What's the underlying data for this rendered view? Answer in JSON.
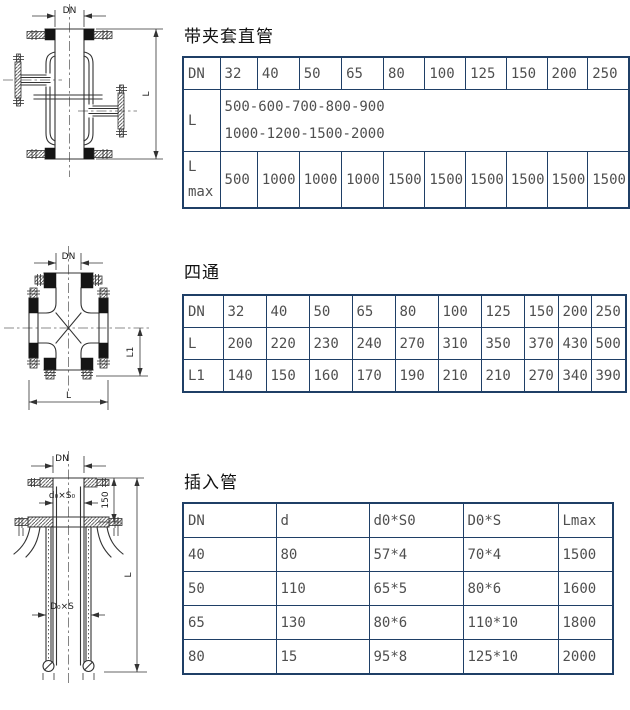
{
  "colors": {
    "table_border": "#1f3f66",
    "table_text": "#4f4f4f",
    "line": "#333333"
  },
  "section1": {
    "title": "带夹套直管",
    "drawing": {
      "dim_dn": "DN",
      "dim_l": "L"
    },
    "table": {
      "row_dn": {
        "label": "DN",
        "values": [
          "32",
          "40",
          "50",
          "65",
          "80",
          "100",
          "125",
          "150",
          "200",
          "250"
        ]
      },
      "row_l": {
        "label": "L",
        "line1": "500-600-700-800-900",
        "line2": "1000-1200-1500-2000"
      },
      "row_lmax": {
        "label_line1": "L",
        "label_line2": "max",
        "values": [
          "500",
          "1000",
          "1000",
          "1000",
          "1500",
          "1500",
          "1500",
          "1500",
          "1500",
          "1500"
        ]
      }
    }
  },
  "section2": {
    "title": "四通",
    "drawing": {
      "dim_dn": "DN",
      "dim_l1": "L1",
      "dim_l": "L"
    },
    "table": {
      "row_dn": {
        "label": "DN",
        "values": [
          "32",
          "40",
          "50",
          "65",
          "80",
          "100",
          "125",
          "150",
          "200",
          "250"
        ]
      },
      "row_l": {
        "label": "L",
        "values": [
          "200",
          "220",
          "230",
          "240",
          "270",
          "310",
          "350",
          "370",
          "430",
          "500"
        ]
      },
      "row_l1": {
        "label": "L1",
        "values": [
          "140",
          "150",
          "160",
          "170",
          "190",
          "210",
          "210",
          "270",
          "340",
          "390"
        ]
      }
    }
  },
  "section3": {
    "title": "插入管",
    "drawing": {
      "dim_dn": "DN",
      "dim_d0s0": "d₀×S₀",
      "dim_150": "150",
      "dim_d0s": "D₀×S",
      "dim_l": "L"
    },
    "table": {
      "headers": [
        "DN",
        "d",
        "d0*S0",
        "D0*S",
        "Lmax"
      ],
      "rows": [
        [
          "40",
          "80",
          "57*4",
          "70*4",
          "1500"
        ],
        [
          "50",
          "110",
          "65*5",
          "80*6",
          "1600"
        ],
        [
          "65",
          "130",
          "80*6",
          "110*10",
          "1800"
        ],
        [
          "80",
          "15",
          "95*8",
          "125*10",
          "2000"
        ]
      ]
    }
  }
}
